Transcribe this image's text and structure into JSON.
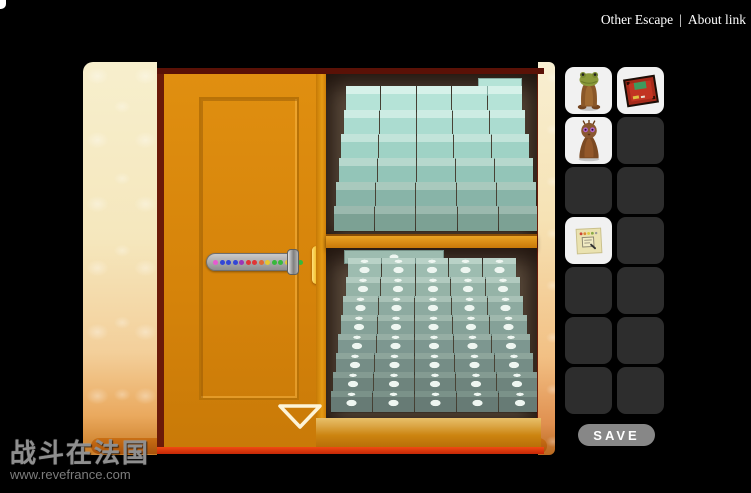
{
  "nav": {
    "links": [
      {
        "label": "Other Escape"
      },
      {
        "label": "About link"
      }
    ],
    "separator": "|"
  },
  "scene": {
    "lock_dots": [
      "#e65ad0",
      "#3347d6",
      "#3347d6",
      "#3347d6",
      "#9a35b8",
      "#e03535",
      "#e03535",
      "#e06a35",
      "#e6c832",
      "#37b83c",
      "#37b83c",
      "#e6c832",
      "#37b83c",
      "#37b83c"
    ],
    "shelves": {
      "top": {
        "rows": 6,
        "cols": 5,
        "dotted": false,
        "front_colors": [
          "#b5e3d7",
          "#abdcd0",
          "#9fd2c5",
          "#93c5b8",
          "#88b4a8",
          "#7ca194"
        ],
        "top_colors": [
          "#d6f1e9",
          "#cdece3",
          "#c2e4da",
          "#b6d8cd",
          "#a9c9bd",
          "#9bb9ae"
        ]
      },
      "bottom": {
        "rows": 8,
        "cols": 5,
        "dotted": true,
        "front_colors": [
          "#9dbcb0",
          "#95b3a7",
          "#8daaa0",
          "#85a198",
          "#7d9790",
          "#758d86",
          "#6e847d",
          "#677b75"
        ],
        "top_colors": [
          "#b9d2c7",
          "#b1cabf",
          "#a8c1b6",
          "#9fb8ad",
          "#96aea4",
          "#8da59b",
          "#849b92",
          "#7b9289"
        ]
      }
    },
    "colors": {
      "door_orange": "#d5830a",
      "frame_maroon": "#5a1106",
      "wall_cream": "#f6eec9",
      "wall_peach": "#f2b57e",
      "interior_brown": "#5c4c3d",
      "floor_red": "#e8380d",
      "handle_gold": "#f0b91e",
      "slot_empty": "#2d2d2d",
      "slot_filled": "#f1f1f1"
    }
  },
  "inventory": {
    "rows": 7,
    "cols": 2,
    "items": [
      {
        "slot": 0,
        "name": "frog-figurine"
      },
      {
        "slot": 1,
        "name": "framed-picture"
      },
      {
        "slot": 2,
        "name": "owl-figurine"
      },
      {
        "slot": 6,
        "name": "note-card"
      }
    ],
    "save_label": "SAVE"
  },
  "watermark": {
    "title": "战斗在法国",
    "url": "www.revefrance.com"
  }
}
